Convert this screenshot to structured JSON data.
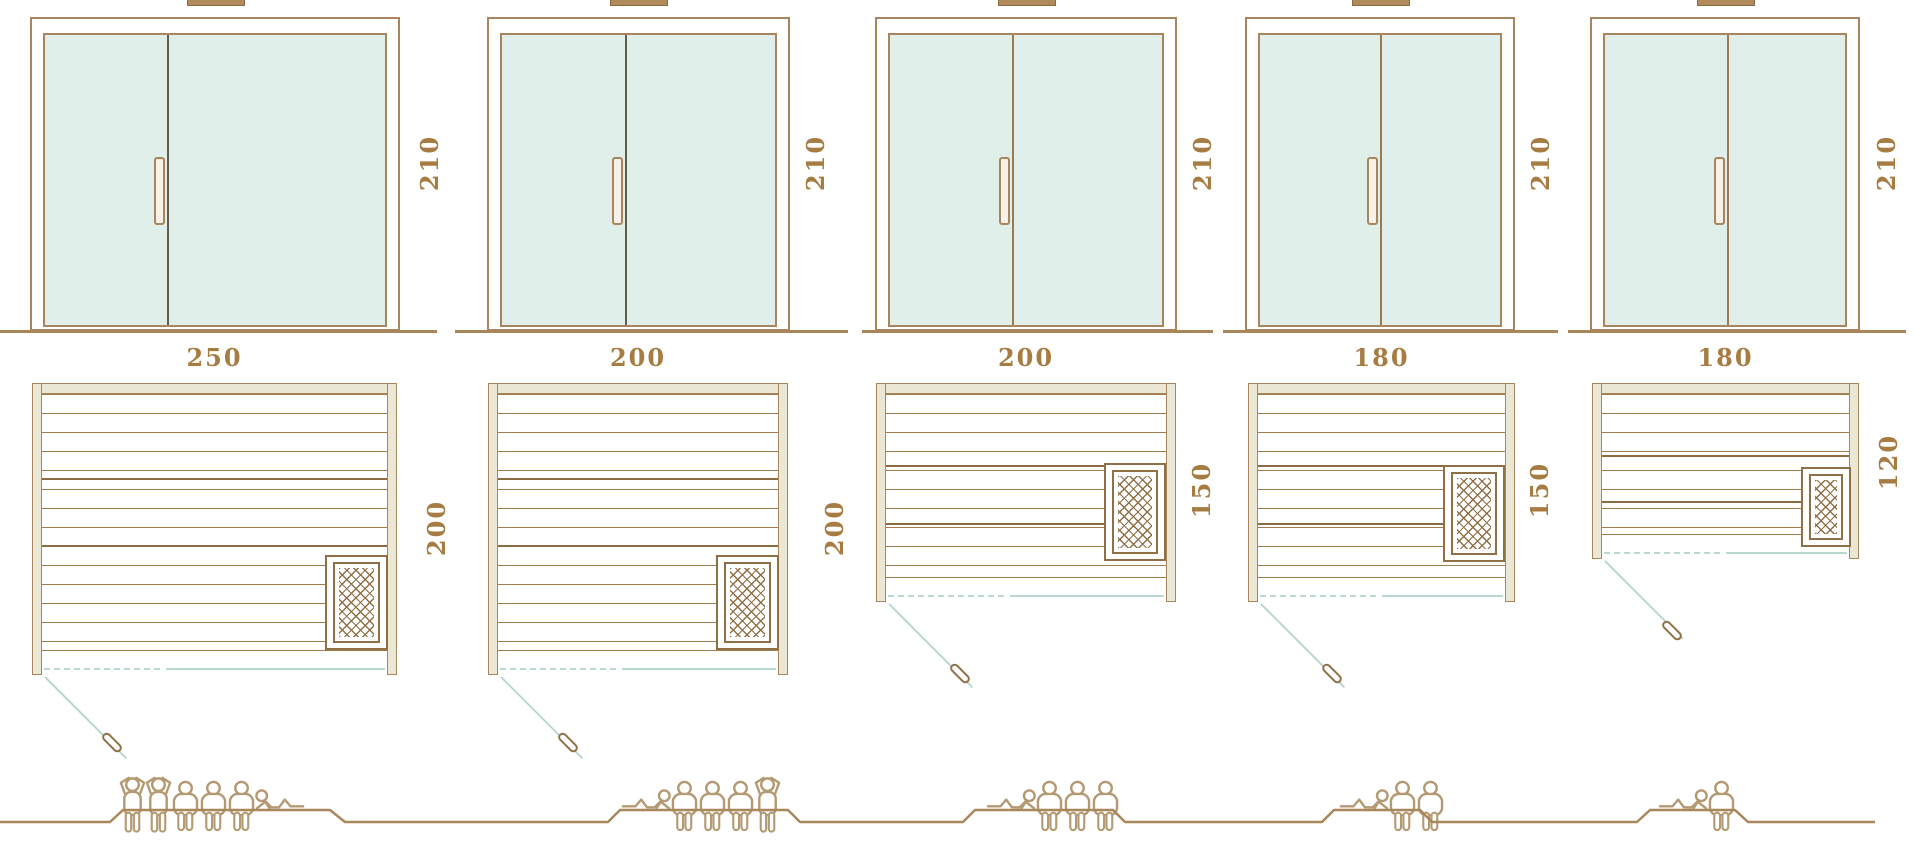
{
  "diagram": {
    "kind": "sauna-size-comparison",
    "views": [
      "front-elevation",
      "floor-plan",
      "capacity-figures"
    ]
  },
  "saunas": [
    {
      "name": "sauna-250x200",
      "door_height": "210",
      "width": "250",
      "depth": "200",
      "capacity_total": 6,
      "capacity": {
        "standing": 2,
        "sitting": 3,
        "lying": 1
      },
      "figures": [
        "standing",
        "standing",
        "sitting",
        "sitting",
        "sitting",
        "lying"
      ]
    },
    {
      "name": "sauna-200x200",
      "door_height": "210",
      "width": "200",
      "depth": "200",
      "capacity_total": 5,
      "capacity": {
        "standing": 1,
        "sitting": 3,
        "lying": 1
      },
      "figures": [
        "lying-flip",
        "sitting",
        "sitting",
        "sitting",
        "standing"
      ]
    },
    {
      "name": "sauna-200x150",
      "door_height": "210",
      "width": "200",
      "depth": "150",
      "capacity_total": 4,
      "capacity": {
        "standing": 0,
        "sitting": 3,
        "lying": 1
      },
      "figures": [
        "lying-flip",
        "sitting",
        "sitting",
        "sitting"
      ]
    },
    {
      "name": "sauna-180x150",
      "door_height": "210",
      "width": "180",
      "depth": "150",
      "capacity_total": 3,
      "capacity": {
        "standing": 0,
        "sitting": 2,
        "lying": 1
      },
      "figures": [
        "lying-flip",
        "sitting",
        "sitting"
      ]
    },
    {
      "name": "sauna-180x120",
      "door_height": "210",
      "width": "180",
      "depth": "120",
      "capacity_total": 2,
      "capacity": {
        "standing": 0,
        "sitting": 1,
        "lying": 1
      },
      "figures": [
        "lying-flip",
        "sitting"
      ]
    }
  ],
  "colors": {
    "frame_brown": "#a8855c",
    "glass_teal": "#e1efeb",
    "wall_beige": "#eae7d4",
    "door_swing_teal": "#b8d8d1",
    "label_brown": "#a67c42",
    "heater_brown": "#8f6f46",
    "figure_tan": "#b49a73"
  }
}
